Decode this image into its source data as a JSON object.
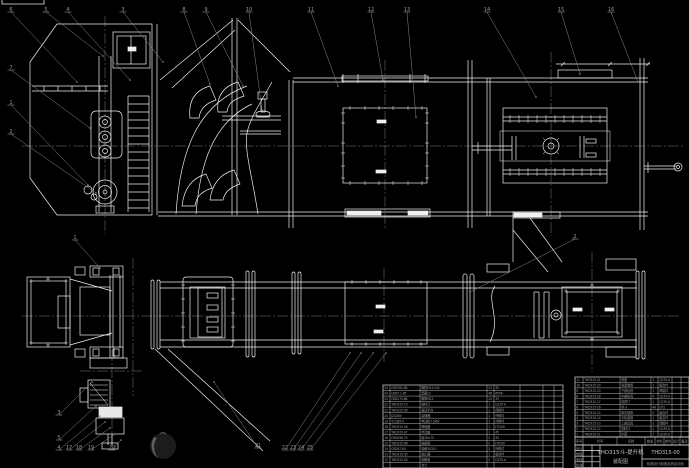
{
  "drawing": {
    "title_line1": "THD315斗-提升机",
    "title_line2": "装配图",
    "drawing_number": "THD315-00",
    "organization": "机械设计制造及其自动化",
    "signature_rows": [
      "设计",
      "制图",
      "审核",
      "批准"
    ],
    "colors": {
      "background": "#000000",
      "line": "#f0f0f0",
      "gray": "#8c8c8c",
      "text": "#9a9a9a"
    }
  },
  "bom": {
    "header": [
      "序号",
      "代号",
      "名称",
      "数量",
      "材料",
      "单件",
      "总计",
      "备注"
    ],
    "right_rows": [
      [
        "11",
        "THD315-21",
        "底座",
        "1",
        "Q235-A",
        "",
        ""
      ],
      [
        "10",
        "THD315-20",
        "张紧装置",
        "1",
        "组合件",
        "",
        ""
      ],
      [
        "9",
        "THD315-19",
        "下部区段",
        "1",
        "焊接件",
        "",
        ""
      ],
      [
        "8",
        "THD315-18",
        "中部机壳",
        "4",
        "Q235-A",
        "",
        ""
      ],
      [
        "7",
        "THD315-17",
        "检视门",
        "1",
        "Q235-A",
        "",
        ""
      ],
      [
        "6",
        "THD315-16",
        "料斗",
        "46",
        "DT2",
        "",
        ""
      ],
      [
        "5",
        "THD315-15",
        "牵引链条",
        "2",
        "组合件",
        "",
        ""
      ],
      [
        "4",
        "THD315-14",
        "头轮装置",
        "1",
        "组合件",
        "",
        ""
      ],
      [
        "3",
        "THD315-13",
        "上部区段",
        "1",
        "焊接件",
        "",
        ""
      ],
      [
        "2",
        "THD315-12",
        "卸料口",
        "1",
        "Q235-A",
        "",
        ""
      ],
      [
        "1",
        "THD315-11",
        "护罩",
        "1",
        "Q235-A",
        "",
        ""
      ]
    ],
    "left_rows": [
      [
        "25",
        "GB5782-86",
        "螺栓M12×45",
        "24",
        "35",
        "",
        "",
        ""
      ],
      [
        "24",
        "GB97.1-85",
        "垫圈12",
        "48",
        "65Mn",
        "",
        "",
        ""
      ],
      [
        "23",
        "GB6170-86",
        "螺母M12",
        "24",
        "35",
        "",
        "",
        ""
      ],
      [
        "22",
        "THD315-10",
        "进料口",
        "1",
        "Q235-A",
        "",
        "",
        ""
      ],
      [
        "21",
        "THD315-09",
        "驱动平台",
        "1",
        "焊接件",
        "",
        "",
        ""
      ],
      [
        "20",
        "JZQ400",
        "减速器",
        "1",
        "外购件",
        "",
        "",
        ""
      ],
      [
        "19",
        "Y132M-4",
        "电动机7.5kW",
        "1",
        "外购件",
        "",
        "",
        ""
      ],
      [
        "18",
        "THD315-08",
        "联轴器",
        "1",
        "HT200",
        "",
        "",
        ""
      ],
      [
        "17",
        "THD315-07",
        "传动轴",
        "1",
        "45",
        "",
        "",
        ""
      ],
      [
        "16",
        "GB1096-79",
        "键16×70",
        "2",
        "45",
        "",
        "",
        ""
      ],
      [
        "15",
        "THD315-06",
        "轴承座",
        "2",
        "HT200",
        "",
        "",
        ""
      ],
      [
        "14",
        "GB297-84",
        "轴承30310",
        "2",
        "外购件",
        "",
        "",
        ""
      ],
      [
        "13",
        "THD315-05",
        "逆止器",
        "1",
        "组合件",
        "",
        "",
        ""
      ],
      [
        "12",
        "THD315-04",
        "观察窗",
        "2",
        "Q235-A",
        "",
        "",
        ""
      ],
      [
        "",
        "",
        "合计",
        "",
        "",
        "",
        "",
        ""
      ]
    ]
  },
  "callouts": {
    "top": [
      {
        "n": "6",
        "x": 9,
        "y": 9,
        "tx": 77,
        "ty": 82
      },
      {
        "n": "5",
        "x": 44,
        "y": 9,
        "tx": 103,
        "ty": 56
      },
      {
        "n": "4",
        "x": 66,
        "y": 9,
        "tx": 130,
        "ty": 80
      },
      {
        "n": "3",
        "x": 121,
        "y": 9,
        "tx": 163,
        "ty": 62
      },
      {
        "n": "8",
        "x": 182,
        "y": 9,
        "tx": 210,
        "ty": 84
      },
      {
        "n": "9",
        "x": 204,
        "y": 9,
        "tx": 243,
        "ty": 86
      },
      {
        "n": "10",
        "x": 247,
        "y": 9,
        "tx": 262,
        "ty": 110
      },
      {
        "n": "11",
        "x": 309,
        "y": 9,
        "tx": 338,
        "ty": 86
      },
      {
        "n": "12",
        "x": 369,
        "y": 9,
        "tx": 383,
        "ty": 80
      },
      {
        "n": "13",
        "x": 405,
        "y": 9,
        "tx": 416,
        "ty": 117
      },
      {
        "n": "14",
        "x": 485,
        "y": 9,
        "tx": 536,
        "ty": 97
      },
      {
        "n": "15",
        "x": 559,
        "y": 9,
        "tx": 580,
        "ty": 74
      },
      {
        "n": "16",
        "x": 609,
        "y": 9,
        "tx": 638,
        "ty": 82
      }
    ],
    "left": [
      {
        "n": "7",
        "x": 9,
        "y": 67,
        "tx": 90,
        "ty": 128
      },
      {
        "n": "1",
        "x": 9,
        "y": 102,
        "tx": 88,
        "ty": 185
      },
      {
        "n": "2",
        "x": 9,
        "y": 131,
        "tx": 96,
        "ty": 193
      }
    ],
    "plan": [
      {
        "n": "1",
        "x": 73,
        "y": 237,
        "tx": 100,
        "ty": 268
      },
      {
        "n": "2",
        "x": 573,
        "y": 236,
        "tx": 470,
        "ty": 292
      }
    ],
    "bottom": [
      {
        "n": "3",
        "x": 57,
        "y": 412,
        "tx": 92,
        "ty": 382
      },
      {
        "n": "5",
        "x": 57,
        "y": 437,
        "tx": 96,
        "ty": 406
      },
      {
        "n": "4",
        "x": 57,
        "y": 447,
        "tx": 100,
        "ty": 416
      },
      {
        "n": "17",
        "x": 67,
        "y": 447,
        "tx": 105,
        "ty": 422
      },
      {
        "n": "18",
        "x": 77,
        "y": 447,
        "tx": 110,
        "ty": 428
      },
      {
        "n": "19",
        "x": 89,
        "y": 447,
        "tx": 115,
        "ty": 434
      },
      {
        "n": "20",
        "x": 110,
        "y": 447,
        "tx": 121,
        "ty": 440
      },
      {
        "n": "21",
        "x": 256,
        "y": 445,
        "tx": 214,
        "ty": 382
      },
      {
        "n": "22",
        "x": 283,
        "y": 447,
        "tx": 350,
        "ty": 353
      },
      {
        "n": "23",
        "x": 291,
        "y": 447,
        "tx": 361,
        "ty": 353
      },
      {
        "n": "24",
        "x": 299,
        "y": 447,
        "tx": 373,
        "ty": 353
      },
      {
        "n": "25",
        "x": 308,
        "y": 447,
        "tx": 386,
        "ty": 353
      }
    ]
  }
}
